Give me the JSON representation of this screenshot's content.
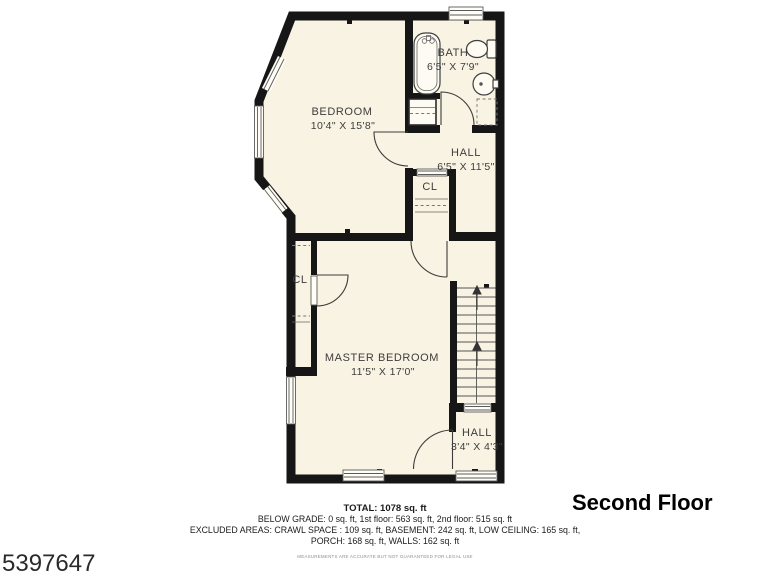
{
  "colors": {
    "floor_fill": "#f8f3e3",
    "wall": "#161616",
    "label": "#3d3d3d"
  },
  "plan": {
    "labels": {
      "bedroom": {
        "name": "BEDROOM",
        "dims": "10'4\" X 15'8\""
      },
      "bath": {
        "name": "BATH",
        "dims": "6'5\" X 7'9\""
      },
      "hall_upper": {
        "name": "HALL",
        "dims": "6'5\" X 11'5\""
      },
      "closet_upper": {
        "name": "CL"
      },
      "closet_left": {
        "name": "CL"
      },
      "master_bedroom": {
        "name": "MASTER BEDROOM",
        "dims": "11'5\" X 17'0\""
      },
      "hall_lower": {
        "name": "HALL",
        "dims": "3'4\" X 4'3\""
      }
    }
  },
  "summary": {
    "total": "TOTAL: 1078 sq. ft",
    "grade_line": "BELOW GRADE: 0 sq. ft, 1st floor: 563 sq. ft, 2nd floor: 515 sq. ft",
    "excluded_line1": "EXCLUDED AREAS: CRAWL SPACE : 109 sq. ft, BASEMENT: 242 sq. ft, LOW CEILING: 165 sq. ft,",
    "excluded_line2": "PORCH: 168 sq. ft, WALLS: 162 sq. ft",
    "disclaimer": "MEASUREMENTS ARE ACCURATE BUT NOT GUARANTEED FOR LEGAL USE"
  },
  "floor_title": "Second Floor",
  "listing_number": "5397647"
}
